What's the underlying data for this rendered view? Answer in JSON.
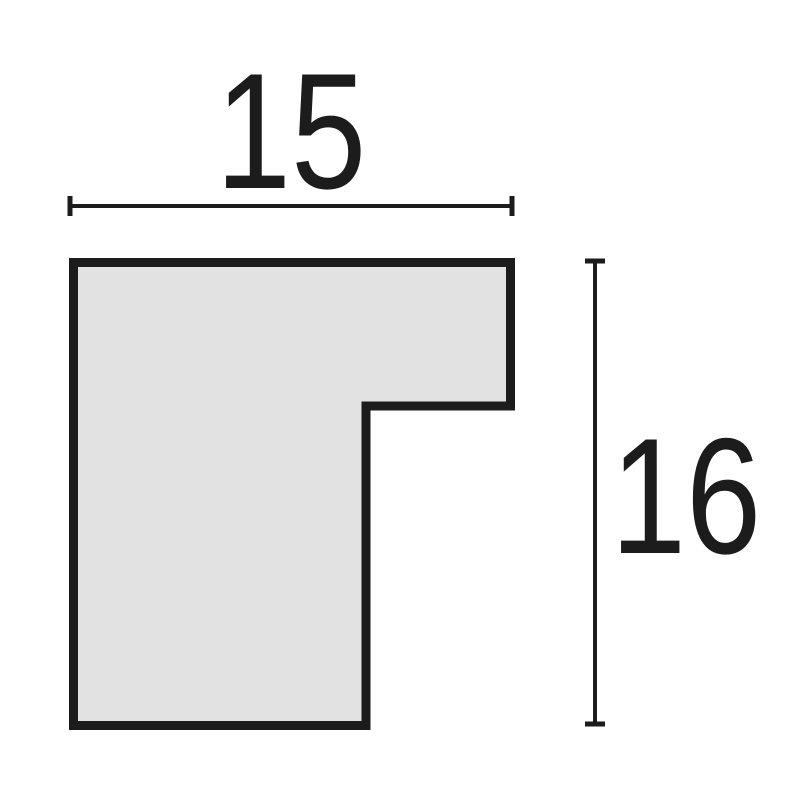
{
  "drawing": {
    "subject": "frame-profile-cross-section",
    "background": "#ffffff",
    "ink_color": "#1c1c1c",
    "profile": {
      "fill": "#e2e2e2",
      "stroke": "#1c1c1c",
      "stroke_width": "9",
      "points": "73.5,262.5 510.5,262.5 510.5,406 366,406 366,725.5 73.5,725.5"
    },
    "dimensions": {
      "width": {
        "label": "15",
        "value": 15,
        "orientation": "horizontal"
      },
      "height": {
        "label": "16",
        "value": 16,
        "orientation": "vertical"
      }
    }
  }
}
